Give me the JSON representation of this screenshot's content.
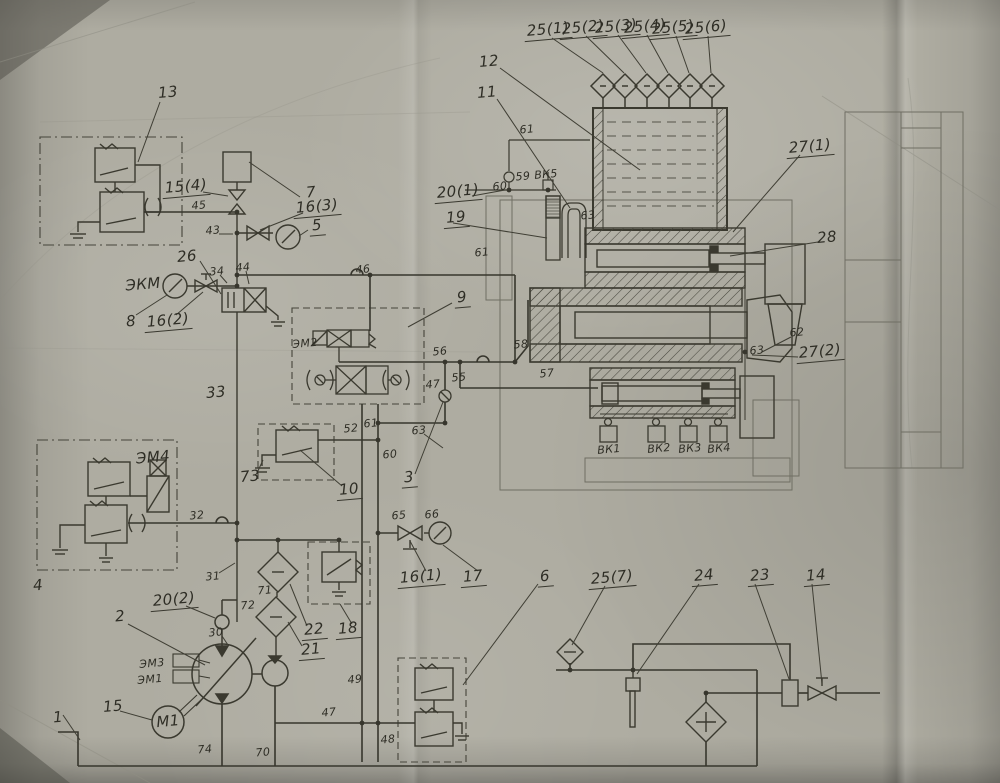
{
  "colors": {
    "paper": "#aeaca1",
    "ink": "#3a392f",
    "ink_light": "#73726a",
    "label_ink": "#2e2d25"
  },
  "labels": [
    {
      "name": "25-1",
      "text": "25(1)",
      "x": 548,
      "y": 31,
      "u": true
    },
    {
      "name": "25-2",
      "text": "25(2)",
      "x": 583,
      "y": 29,
      "u": true
    },
    {
      "name": "25-3",
      "text": "25(3)",
      "x": 616,
      "y": 28,
      "u": true
    },
    {
      "name": "25-4",
      "text": "25(4)",
      "x": 645,
      "y": 28,
      "u": true
    },
    {
      "name": "25-5",
      "text": "25(5)",
      "x": 673,
      "y": 29,
      "u": true
    },
    {
      "name": "25-6",
      "text": "25(6)",
      "x": 706,
      "y": 29,
      "u": true
    },
    {
      "name": "12",
      "text": "12",
      "x": 489,
      "y": 62
    },
    {
      "name": "11",
      "text": "11",
      "x": 487,
      "y": 93
    },
    {
      "name": "61-top",
      "text": "61",
      "x": 527,
      "y": 130,
      "s": true
    },
    {
      "name": "59",
      "text": "59",
      "x": 523,
      "y": 177,
      "s": true
    },
    {
      "name": "vk5",
      "text": "ВК5",
      "x": 546,
      "y": 175,
      "s": true
    },
    {
      "name": "60-top",
      "text": "60",
      "x": 500,
      "y": 187,
      "s": true
    },
    {
      "name": "20-1",
      "text": "20(1)",
      "x": 458,
      "y": 193,
      "u": true
    },
    {
      "name": "19",
      "text": "19",
      "x": 456,
      "y": 219,
      "u": true
    },
    {
      "name": "63-top",
      "text": "63",
      "x": 588,
      "y": 216,
      "s": true
    },
    {
      "name": "61-mid",
      "text": "61",
      "x": 482,
      "y": 253,
      "s": true
    },
    {
      "name": "27-1",
      "text": "27(1)",
      "x": 810,
      "y": 148,
      "u": true
    },
    {
      "name": "28",
      "text": "28",
      "x": 827,
      "y": 238
    },
    {
      "name": "13",
      "text": "13",
      "x": 168,
      "y": 93
    },
    {
      "name": "15-4",
      "text": "15(4)",
      "x": 186,
      "y": 188,
      "u": true
    },
    {
      "name": "7",
      "text": "7",
      "x": 311,
      "y": 193
    },
    {
      "name": "45",
      "text": "45",
      "x": 199,
      "y": 206,
      "s": true
    },
    {
      "name": "16-3",
      "text": "16(3)",
      "x": 317,
      "y": 208,
      "u": true
    },
    {
      "name": "43",
      "text": "43",
      "x": 213,
      "y": 231,
      "s": true
    },
    {
      "name": "5",
      "text": "5",
      "x": 317,
      "y": 227,
      "u": true
    },
    {
      "name": "26",
      "text": "26",
      "x": 187,
      "y": 257
    },
    {
      "name": "44",
      "text": "44",
      "x": 243,
      "y": 268,
      "s": true
    },
    {
      "name": "34",
      "text": "34",
      "x": 217,
      "y": 272,
      "s": true
    },
    {
      "name": "46",
      "text": "46",
      "x": 363,
      "y": 270,
      "s": true
    },
    {
      "name": "ekm",
      "text": "ЭКМ",
      "x": 143,
      "y": 285
    },
    {
      "name": "8",
      "text": "8",
      "x": 131,
      "y": 322
    },
    {
      "name": "16-2",
      "text": "16(2)",
      "x": 168,
      "y": 322,
      "u": true
    },
    {
      "name": "9",
      "text": "9",
      "x": 462,
      "y": 299,
      "u": true
    },
    {
      "name": "em2",
      "text": "ЭМ2",
      "x": 305,
      "y": 344,
      "s": true
    },
    {
      "name": "56",
      "text": "56",
      "x": 440,
      "y": 352,
      "s": true
    },
    {
      "name": "58",
      "text": "58",
      "x": 521,
      "y": 345,
      "s": true
    },
    {
      "name": "55",
      "text": "55",
      "x": 459,
      "y": 378,
      "s": true
    },
    {
      "name": "47-check",
      "text": "47",
      "x": 433,
      "y": 385,
      "s": true
    },
    {
      "name": "57",
      "text": "57",
      "x": 547,
      "y": 374,
      "s": true
    },
    {
      "name": "33",
      "text": "33",
      "x": 216,
      "y": 393
    },
    {
      "name": "52",
      "text": "52",
      "x": 351,
      "y": 429,
      "s": true
    },
    {
      "name": "61-low",
      "text": "61",
      "x": 371,
      "y": 424,
      "s": true
    },
    {
      "name": "63-mid",
      "text": "63",
      "x": 419,
      "y": 431,
      "s": true
    },
    {
      "name": "60-low",
      "text": "60",
      "x": 390,
      "y": 455,
      "s": true
    },
    {
      "name": "73",
      "text": "73",
      "x": 250,
      "y": 477
    },
    {
      "name": "3",
      "text": "3",
      "x": 409,
      "y": 479,
      "u": true
    },
    {
      "name": "10",
      "text": "10",
      "x": 349,
      "y": 491,
      "u": true
    },
    {
      "name": "em4",
      "text": "ЭМ4",
      "x": 153,
      "y": 458
    },
    {
      "name": "32",
      "text": "32",
      "x": 197,
      "y": 516,
      "s": true
    },
    {
      "name": "4",
      "text": "4",
      "x": 38,
      "y": 586
    },
    {
      "name": "31",
      "text": "31",
      "x": 213,
      "y": 577,
      "s": true
    },
    {
      "name": "20-2",
      "text": "20(2)",
      "x": 174,
      "y": 601,
      "u": true
    },
    {
      "name": "2",
      "text": "2",
      "x": 120,
      "y": 617
    },
    {
      "name": "30",
      "text": "30",
      "x": 216,
      "y": 633,
      "s": true
    },
    {
      "name": "71",
      "text": "71",
      "x": 265,
      "y": 591,
      "s": true
    },
    {
      "name": "72",
      "text": "72",
      "x": 248,
      "y": 606,
      "s": true
    },
    {
      "name": "22",
      "text": "22",
      "x": 314,
      "y": 631,
      "u": true
    },
    {
      "name": "21",
      "text": "21",
      "x": 311,
      "y": 651,
      "u": true
    },
    {
      "name": "18",
      "text": "18",
      "x": 348,
      "y": 630,
      "u": true
    },
    {
      "name": "65",
      "text": "65",
      "x": 399,
      "y": 516,
      "s": true
    },
    {
      "name": "66",
      "text": "66",
      "x": 432,
      "y": 515,
      "s": true
    },
    {
      "name": "16-1",
      "text": "16(1)",
      "x": 421,
      "y": 578,
      "u": true
    },
    {
      "name": "17",
      "text": "17",
      "x": 473,
      "y": 578,
      "u": true
    },
    {
      "name": "6",
      "text": "6",
      "x": 545,
      "y": 578,
      "u": true
    },
    {
      "name": "25-7",
      "text": "25(7)",
      "x": 612,
      "y": 579,
      "u": true
    },
    {
      "name": "24",
      "text": "24",
      "x": 704,
      "y": 577,
      "u": true
    },
    {
      "name": "23",
      "text": "23",
      "x": 760,
      "y": 577,
      "u": true
    },
    {
      "name": "14",
      "text": "14",
      "x": 816,
      "y": 577,
      "u": true
    },
    {
      "name": "em3",
      "text": "ЭМ3",
      "x": 152,
      "y": 664,
      "s": true
    },
    {
      "name": "em1",
      "text": "ЭМ1",
      "x": 150,
      "y": 680,
      "s": true
    },
    {
      "name": "m1",
      "text": "М1",
      "x": 168,
      "y": 722
    },
    {
      "name": "15",
      "text": "15",
      "x": 113,
      "y": 707
    },
    {
      "name": "1",
      "text": "1",
      "x": 58,
      "y": 718
    },
    {
      "name": "74",
      "text": "74",
      "x": 205,
      "y": 750,
      "s": true
    },
    {
      "name": "70",
      "text": "70",
      "x": 263,
      "y": 753,
      "s": true
    },
    {
      "name": "47-line",
      "text": "47",
      "x": 329,
      "y": 713,
      "s": true
    },
    {
      "name": "49",
      "text": "49",
      "x": 355,
      "y": 680,
      "s": true
    },
    {
      "name": "48",
      "text": "48",
      "x": 388,
      "y": 740,
      "s": true
    },
    {
      "name": "vk1",
      "text": "ВК1",
      "x": 609,
      "y": 450,
      "s": true
    },
    {
      "name": "vk2",
      "text": "ВК2",
      "x": 659,
      "y": 449,
      "s": true
    },
    {
      "name": "vk3",
      "text": "ВК3",
      "x": 690,
      "y": 449,
      "s": true
    },
    {
      "name": "vk4",
      "text": "ВК4",
      "x": 719,
      "y": 449,
      "s": true
    },
    {
      "name": "62",
      "text": "62",
      "x": 797,
      "y": 333,
      "s": true
    },
    {
      "name": "63-right",
      "text": "63",
      "x": 757,
      "y": 351,
      "s": true
    },
    {
      "name": "27-2",
      "text": "27(2)",
      "x": 820,
      "y": 353,
      "u": true
    }
  ]
}
